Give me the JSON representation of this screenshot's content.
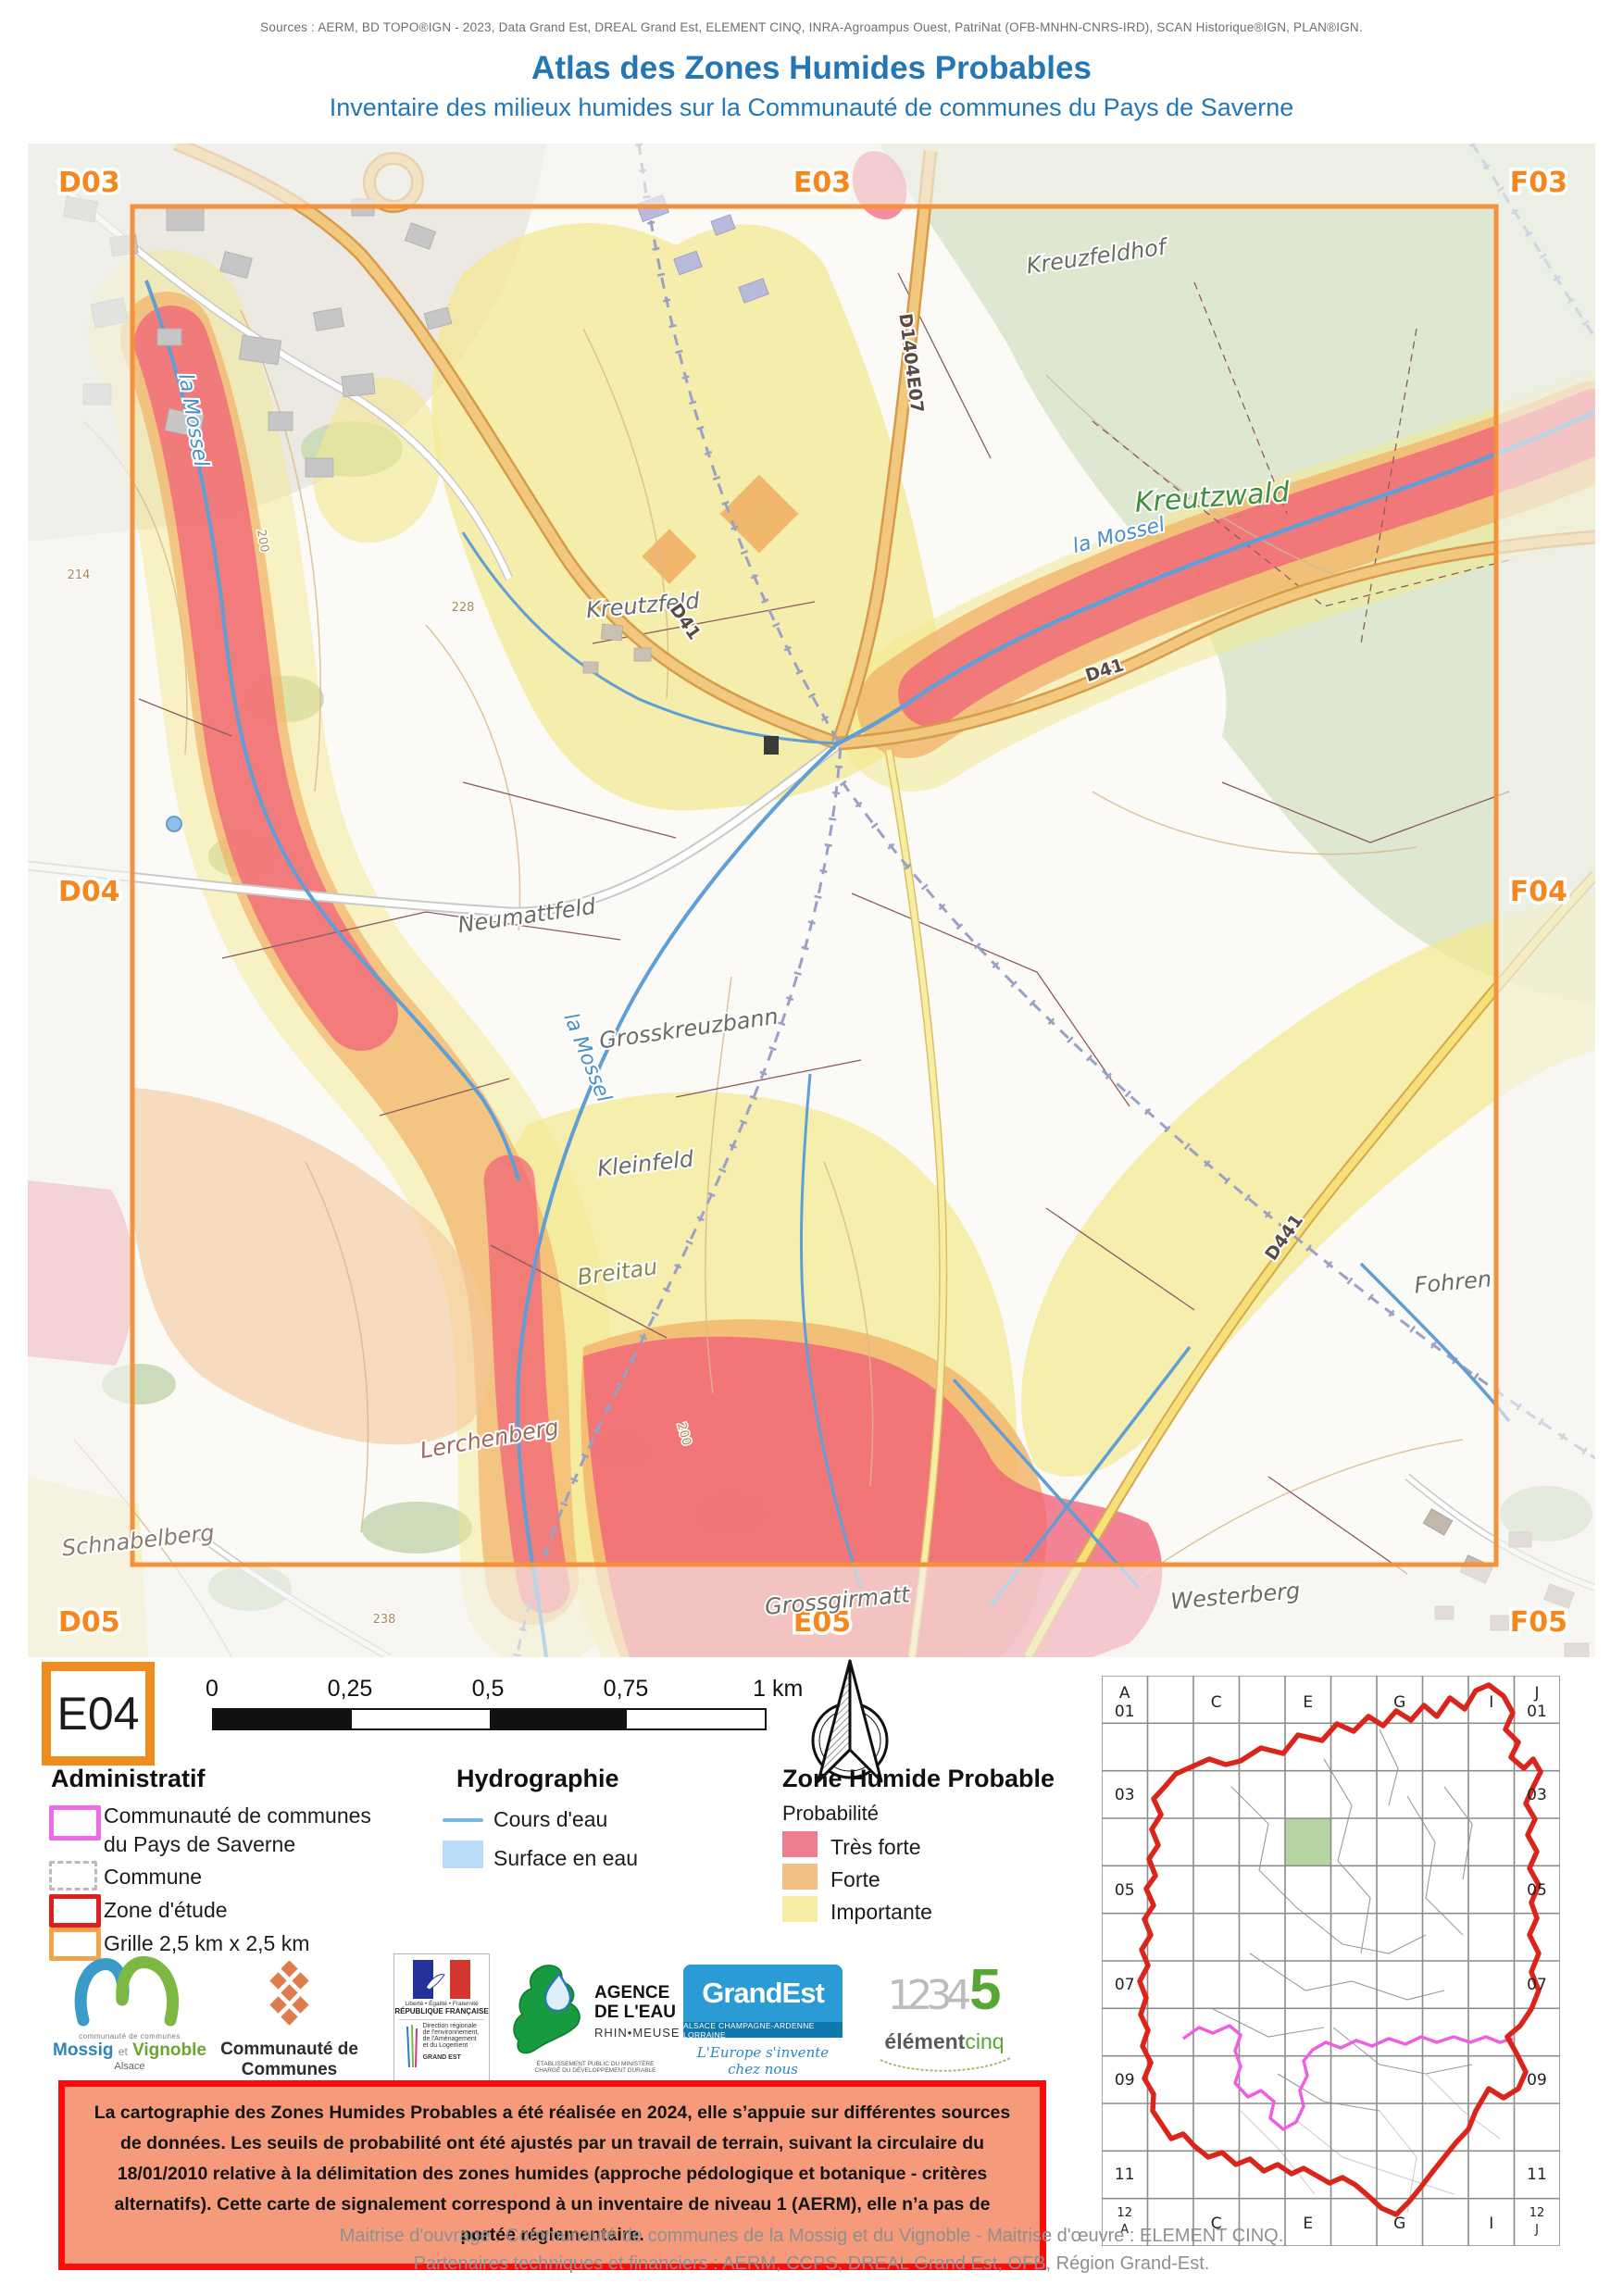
{
  "header": {
    "sources": "Sources : AERM, BD TOPO®IGN - 2023, Data Grand Est, DREAL Grand Est, ELEMENT CINQ, INRA-Agroampus Ouest, PatriNat (OFB-MNHN-CNRS-IRD), SCAN Historique®IGN, PLAN®IGN.",
    "title": "Atlas des Zones Humides Probables",
    "subtitle": "Inventaire des milieux humides sur la Communauté de communes du Pays de Saverne"
  },
  "map": {
    "cell_labels": {
      "d03": "D03",
      "e03": "E03",
      "f03": "F03",
      "d04": "D04",
      "f04": "F04",
      "d05": "D05",
      "e05": "E05",
      "f05": "F05"
    },
    "place_labels": {
      "kreuzfeldhof": "Kreuzfeldhof",
      "kreutzwald": "Kreutzwald",
      "kreutzfeld": "Kreutzfeld",
      "neumattfeld": "Neumattfeld",
      "grosskreuzbann": "Grosskreuzbann",
      "kleinfeld": "Kleinfeld",
      "breitau": "Breitau",
      "fohren": "Fohren",
      "lerchenberg": "Lerchenberg",
      "schnabelberg": "Schnabelberg",
      "grossgirmatt": "Grossgirmatt",
      "westerberg": "Westerberg"
    },
    "road_labels": {
      "d41_a": "D41",
      "d41_b": "D41",
      "d1404e07": "D1404E07",
      "d441": "D441"
    },
    "river_labels": {
      "mossel_a": "la Mossel",
      "mossel_b": "la Mossel",
      "mossel_c": "la Mossel"
    },
    "contour_labels": {
      "c200a": "200",
      "c200b": "200",
      "c228": "228",
      "c238": "238",
      "c214": "214"
    }
  },
  "panel": {
    "cell_id": "E04",
    "scalebar": {
      "t0": "0",
      "t1": "0,25",
      "t2": "0,5",
      "t3": "0,75",
      "t4": "1 km"
    },
    "legend": {
      "administratif": {
        "title": "Administratif",
        "items": [
          {
            "label": "Communauté de communes",
            "label2": "du Pays de Saverne",
            "swatch": "magenta-outline"
          },
          {
            "label": "Commune",
            "swatch": "dashed-gray-outline"
          },
          {
            "label": "Zone d'étude",
            "swatch": "red-outline"
          },
          {
            "label": "Grille 2,5 km x 2,5 km",
            "swatch": "orange-outline"
          }
        ]
      },
      "hydrographie": {
        "title": "Hydrographie",
        "items": [
          {
            "label": "Cours d'eau",
            "swatch": "blue-line"
          },
          {
            "label": "Surface en eau",
            "swatch": "lightblue-fill"
          }
        ]
      },
      "zhp": {
        "title": "Zone Humide Probable",
        "subtitle": "Probabilité",
        "items": [
          {
            "label": "Très forte",
            "color": "#EE7E8D"
          },
          {
            "label": "Forte",
            "color": "#F2C083"
          },
          {
            "label": "Importante",
            "color": "#F5EDA4"
          }
        ]
      }
    },
    "logos": {
      "mossig": {
        "line_small": "communauté de communes",
        "name_a": "Mossig",
        "name_et": "et",
        "name_b": "Vignoble",
        "region": "Alsace"
      },
      "ccps": {
        "line1": "Communauté de Communes",
        "line2": "du Pays de Saverne"
      },
      "rf": {
        "motto": "Liberté • Égalité • Fraternité",
        "name": "RÉPUBLIQUE FRANÇAISE",
        "dreal1": "Direction régionale",
        "dreal2": "de l'environnement,",
        "dreal3": "de l'Aménagement",
        "dreal4": "et du Logement",
        "dreal5": "GRAND EST"
      },
      "aerm": {
        "l1": "AGENCE",
        "l2": "DE L'EAU",
        "l3": "RHIN•MEUSE",
        "l4": "ÉTABLISSEMENT PUBLIC DU MINISTÈRE",
        "l5": "CHARGÉ DU DÉVELOPPEMENT DURABLE"
      },
      "grandest": {
        "name": "GrandEst",
        "bar": "ALSACE CHAMPAGNE-ARDENNE LORRAINE",
        "tagline": "L'Europe s'invente chez nous"
      },
      "element5": {
        "digits": "1234",
        "five": "5",
        "word_a": "élément",
        "word_b": "cinq"
      }
    }
  },
  "warning": {
    "text": "La cartographie des Zones Humides Probables a été réalisée en 2024, elle s’appuie sur différentes sources de données. Les seuils de probabilité ont été ajustés par un travail de terrain, suivant la circulaire du 18/01/2010 relative à la délimitation des zones humides (approche pédologique et botanique - critères alternatifs). Cette carte de signalement correspond à un inventaire de niveau 1 (AERM), elle n’a pas de portée réglementaire."
  },
  "footer": {
    "line1": "Maitrise d'ouvrage : Communauté de communes de la Mossig et du Vignoble - Maitrise d'œuvre : ELEMENT CINQ.",
    "line2": "Partenaires techniques et financiers : AERM, CCPS, DREAL Grand Est, OFB, Région Grand-Est."
  },
  "minimap": {
    "highlighted_cell": "E04",
    "top": {
      "a": "A",
      "a_num": "01",
      "c": "C",
      "e": "E",
      "g": "G",
      "i": "I",
      "j": "J",
      "j_num": "01"
    },
    "left": {
      "r03": "03",
      "r05": "05",
      "r07": "07",
      "r09": "09",
      "r11": "11",
      "r12": "12",
      "r12l": "A"
    },
    "right": {
      "r03": "03",
      "r05": "05",
      "r07": "07",
      "r09": "09",
      "r11": "11",
      "r12": "12",
      "r12l": "J"
    },
    "bottom": {
      "c": "C",
      "e": "E",
      "g": "G",
      "i": "I"
    }
  },
  "colors": {
    "accent_orange": "#F08C1E",
    "grid_orange": "#F5913B",
    "zone_red": "#E02020",
    "cc_magenta": "#F06AE6",
    "title_blue": "#2576B4",
    "tres_forte": "#EE7E8D",
    "forte": "#F2C083",
    "importante": "#F5EDA4",
    "surface_eau": "#BADCF8",
    "cours_eau": "#7AB4E0",
    "warning_bg": "#F59B7C",
    "warning_border": "#FE0A0A"
  }
}
